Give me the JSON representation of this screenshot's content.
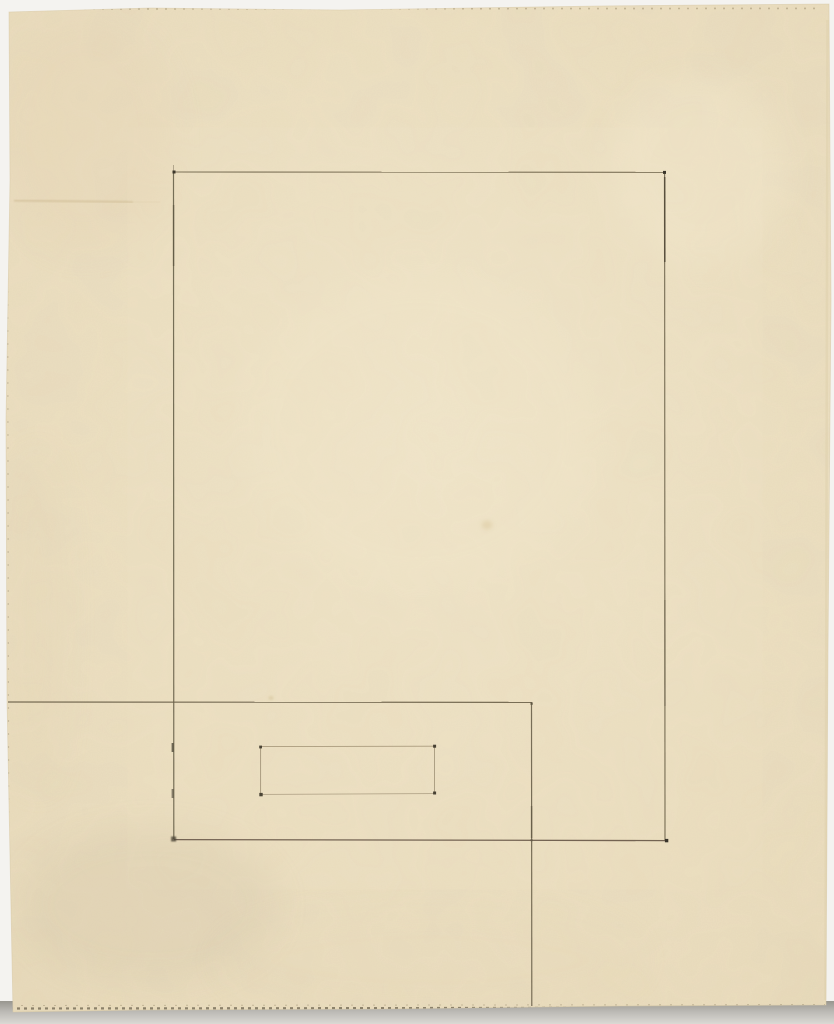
{
  "canvas": {
    "width": 834,
    "height": 1024
  },
  "colors": {
    "backdrop": "#f4f3f0",
    "shadow_strip_dark": "#98968f",
    "shadow_strip_mid": "#bbb9b4",
    "shadow_strip_light": "#dbd9d4",
    "paper_center": "#f0e5c9",
    "paper_edge": "#e9dbba",
    "paper_outline": "#d9c9a6",
    "line_dark": "#4c4433",
    "line_medium": "#6f6750",
    "line_faint": "#a39476",
    "dot": "#3a352a"
  },
  "paper": {
    "points": "9,12 150,8 340,10 600,6 829,4 831,300 828,650 826,1005 620,1006 380,1009 140,1010 13,1012 7,700 6,420 10,180"
  },
  "drawing": {
    "strokes": [
      {
        "name": "large-rect-top-edge",
        "x1": 174,
        "y1": 172,
        "x2": 664.5,
        "y2": 172.3,
        "w": 1.1,
        "color": "#776b52",
        "op": 0.95
      },
      {
        "name": "large-rect-right-edge",
        "x1": 664.6,
        "y1": 172,
        "x2": 665,
        "y2": 840,
        "w": 1.15,
        "color": "#756a52",
        "op": 0.95
      },
      {
        "name": "large-rect-bottom-edge",
        "x1": 174,
        "y1": 839.6,
        "x2": 666.5,
        "y2": 840.6,
        "w": 1.3,
        "color": "#6d5c4c",
        "op": 0.95
      },
      {
        "name": "large-rect-left-edge",
        "x1": 173.5,
        "y1": 172,
        "x2": 173.8,
        "y2": 839,
        "w": 1.2,
        "color": "#6f6750",
        "op": 0.95
      },
      {
        "name": "large-rect-left-overshoot",
        "x1": 173.5,
        "y1": 165,
        "x2": 173.5,
        "y2": 172,
        "w": 1,
        "color": "#7a7059",
        "op": 0.5
      },
      {
        "name": "large-rect-right-dark-segment",
        "x1": 664.7,
        "y1": 177,
        "x2": 664.8,
        "y2": 262,
        "w": 1.6,
        "color": "#4c4433",
        "op": 0.75
      },
      {
        "name": "large-rect-left-dark-segment",
        "x1": 173.6,
        "y1": 205,
        "x2": 173.6,
        "y2": 266,
        "w": 1.5,
        "color": "#55503c",
        "op": 0.55
      },
      {
        "name": "large-rect-right-lower-shade",
        "x1": 664.9,
        "y1": 600,
        "x2": 665,
        "y2": 706,
        "w": 1.3,
        "color": "#5d5440",
        "op": 0.45
      },
      {
        "name": "overlap-horizontal-line",
        "x1": 8,
        "y1": 702,
        "x2": 531.5,
        "y2": 702.4,
        "w": 1.2,
        "color": "#6c6149",
        "op": 0.9
      },
      {
        "name": "overlap-vertical-line",
        "x1": 531.5,
        "y1": 702,
        "x2": 531.8,
        "y2": 1006,
        "w": 1.2,
        "color": "#6a604a",
        "op": 0.9
      },
      {
        "name": "overlap-vertical-dark-segment",
        "x1": 531.6,
        "y1": 806,
        "x2": 531.6,
        "y2": 838,
        "w": 1.6,
        "color": "#58503c",
        "op": 0.5
      },
      {
        "name": "small-rect-top-edge",
        "x1": 261,
        "y1": 746.6,
        "x2": 434,
        "y2": 746.2,
        "w": 0.9,
        "color": "#a39476",
        "op": 0.9
      },
      {
        "name": "small-rect-right-edge",
        "x1": 434.5,
        "y1": 746,
        "x2": 434.5,
        "y2": 793,
        "w": 0.9,
        "color": "#9f9175",
        "op": 0.9
      },
      {
        "name": "small-rect-bottom-edge",
        "x1": 262,
        "y1": 794.4,
        "x2": 434,
        "y2": 793.6,
        "w": 0.9,
        "color": "#aa9c80",
        "op": 0.85
      },
      {
        "name": "small-rect-left-edge",
        "x1": 260.6,
        "y1": 747,
        "x2": 260.6,
        "y2": 794.5,
        "w": 0.9,
        "color": "#9c8e72",
        "op": 0.9
      },
      {
        "name": "graphite-smudge-line",
        "x1": 14,
        "y1": 200.5,
        "x2": 133,
        "y2": 202,
        "w": 2.4,
        "color": "#cdb992",
        "op": 0.5,
        "blur": true
      },
      {
        "name": "graphite-smudge-line-tail",
        "x1": 133,
        "y1": 202,
        "x2": 160,
        "y2": 202.3,
        "w": 2,
        "color": "#d4c29c",
        "op": 0.28,
        "blur": true
      },
      {
        "name": "left-edge-tick-upper",
        "x1": 172.6,
        "y1": 743,
        "x2": 172.6,
        "y2": 752,
        "w": 2,
        "color": "#4f483a",
        "op": 0.8
      },
      {
        "name": "left-edge-tick-lower",
        "x1": 172.6,
        "y1": 789,
        "x2": 172.6,
        "y2": 798,
        "w": 2,
        "color": "#4f483a",
        "op": 0.65
      },
      {
        "name": "paper-top-deckle",
        "x1": 30,
        "y1": 9,
        "x2": 820,
        "y2": 8.4,
        "w": 1.6,
        "color": "#9b8d6d",
        "op": 0.5,
        "dash": "2 7"
      },
      {
        "name": "paper-bottom-deckle",
        "x1": 10,
        "y1": 1008.5,
        "x2": 825,
        "y2": 1007.6,
        "w": 2.2,
        "color": "#6e6450",
        "op": 0.75,
        "dash": "3 4"
      },
      {
        "name": "paper-bottom-deckle-light",
        "x1": 10,
        "y1": 1005.5,
        "x2": 825,
        "y2": 1004.6,
        "w": 1,
        "color": "#8d7f62",
        "op": 0.4,
        "dash": "2 9"
      },
      {
        "name": "paper-left-deckle",
        "x1": 7.5,
        "y1": 200,
        "x2": 9,
        "y2": 1000,
        "w": 1.2,
        "color": "#8d8166",
        "op": 0.32,
        "dash": "2 11"
      },
      {
        "name": "paper-right-edge-shade",
        "x1": 827.5,
        "y1": 20,
        "x2": 825.5,
        "y2": 1000,
        "w": 2.5,
        "color": "#ddcfab",
        "op": 0.5
      }
    ],
    "dots": [
      {
        "name": "large-rect-corner-dot-tl",
        "x": 174,
        "y": 172,
        "s": 3,
        "color": "#3c372b",
        "op": 1
      },
      {
        "name": "large-rect-corner-dot-tr",
        "x": 664.5,
        "y": 172.4,
        "s": 3,
        "color": "#3a352a",
        "op": 1
      },
      {
        "name": "large-rect-corner-dot-br",
        "x": 666.6,
        "y": 840.6,
        "s": 3.4,
        "color": "#38332a",
        "op": 1
      },
      {
        "name": "large-rect-corner-smudge-bl",
        "x": 173.6,
        "y": 839,
        "s": 5,
        "color": "#4a4335",
        "op": 0.8,
        "blur": true
      },
      {
        "name": "small-rect-corner-dot-tl",
        "x": 260.6,
        "y": 747,
        "s": 2.8,
        "color": "#433d2f",
        "op": 0.95
      },
      {
        "name": "small-rect-corner-dot-tr",
        "x": 434.6,
        "y": 746.2,
        "s": 3,
        "color": "#3f392d",
        "op": 0.95
      },
      {
        "name": "small-rect-corner-dot-br",
        "x": 434.6,
        "y": 793,
        "s": 3,
        "color": "#3f392d",
        "op": 0.95
      },
      {
        "name": "small-rect-corner-dot-bl",
        "x": 261,
        "y": 794.6,
        "s": 3.4,
        "color": "#433d2f",
        "op": 0.95
      },
      {
        "name": "overlap-corner-dot",
        "x": 531.6,
        "y": 703.6,
        "s": 2.4,
        "color": "#5a5240",
        "op": 0.8
      },
      {
        "name": "overlap-crossing-dot",
        "x": 531.6,
        "y": 840.2,
        "s": 2.2,
        "color": "#5a5240",
        "op": 0.55
      }
    ],
    "stains": [
      {
        "name": "paper-stain-center-spot",
        "x": 487,
        "y": 525,
        "rx": 5.5,
        "ry": 4.5,
        "color": "#d3bd8f",
        "op": 0.5,
        "blur": "b2"
      },
      {
        "name": "paper-stain-small-spot",
        "x": 271,
        "y": 698,
        "rx": 2.6,
        "ry": 2.2,
        "color": "#d6c59c",
        "op": 0.55,
        "blur": "b1"
      },
      {
        "name": "paper-wash-top-left",
        "x": 85,
        "y": 135,
        "rx": 88,
        "ry": 115,
        "color": "#e4d0b2",
        "op": 0.22,
        "blur": "b16"
      },
      {
        "name": "paper-wash-left-margin",
        "x": 38,
        "y": 620,
        "rx": 26,
        "ry": 170,
        "color": "#e3d4b3",
        "op": 0.2,
        "blur": "b16"
      },
      {
        "name": "paper-wash-bottom-left-gray",
        "x": 150,
        "y": 905,
        "rx": 130,
        "ry": 78,
        "color": "#b7ab93",
        "op": 0.13,
        "blur": "b16"
      },
      {
        "name": "paper-wash-bottom",
        "x": 430,
        "y": 960,
        "rx": 210,
        "ry": 55,
        "color": "#e6d8b8",
        "op": 0.16,
        "blur": "b16"
      },
      {
        "name": "paper-light-top-right",
        "x": 700,
        "y": 170,
        "rx": 90,
        "ry": 95,
        "color": "#f4ead0",
        "op": 0.3,
        "blur": "b16"
      },
      {
        "name": "paper-light-center",
        "x": 420,
        "y": 430,
        "rx": 180,
        "ry": 160,
        "color": "#f2e7cb",
        "op": 0.25,
        "blur": "b16"
      }
    ]
  }
}
